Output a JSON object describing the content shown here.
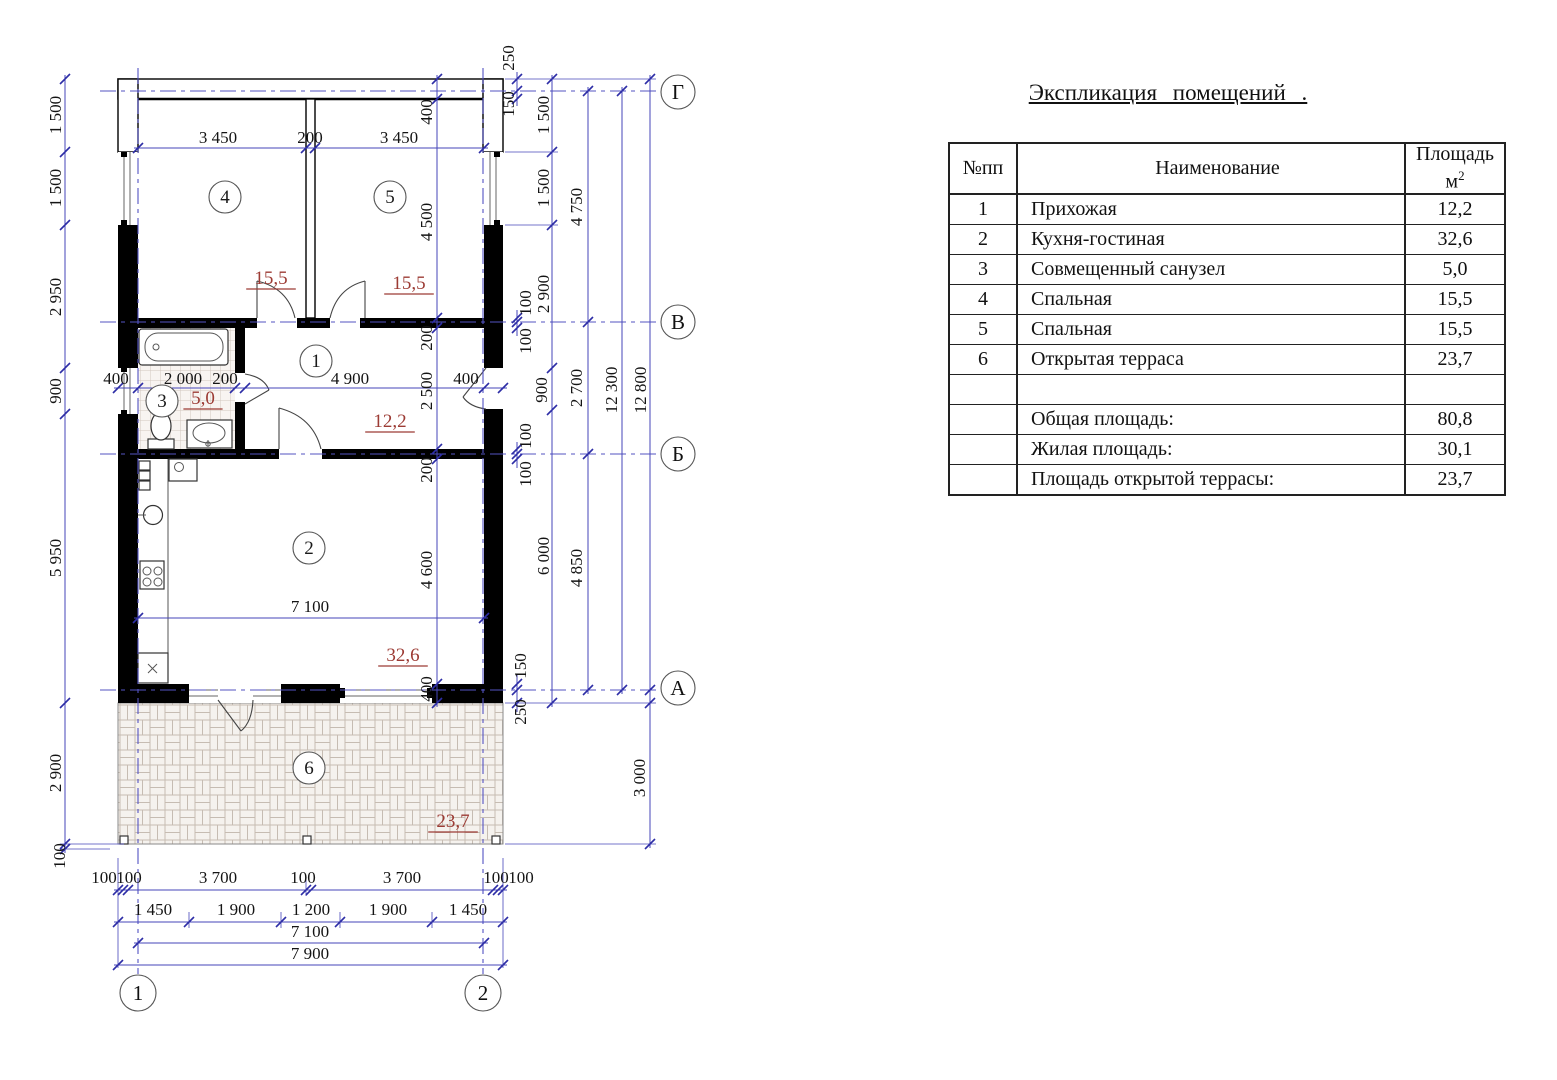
{
  "title": "Экспликация помещений .",
  "table": {
    "col_num": "№пп",
    "col_name": "Наименование",
    "col_area_line1": "Площадь",
    "col_area_unit": "м",
    "col_area_sup": "2",
    "rows": [
      {
        "num": "1",
        "name": "Прихожая",
        "area": "12,2"
      },
      {
        "num": "2",
        "name": "Кухня-гостиная",
        "area": "32,6"
      },
      {
        "num": "3",
        "name": "Совмещенный санузел",
        "area": "5,0"
      },
      {
        "num": "4",
        "name": "Спальная",
        "area": "15,5"
      },
      {
        "num": "5",
        "name": "Спальная",
        "area": "15,5"
      },
      {
        "num": "6",
        "name": "Открытая терраса",
        "area": "23,7"
      },
      {
        "num": "",
        "name": "",
        "area": ""
      },
      {
        "num": "",
        "name": "Общая площадь:",
        "area": "80,8"
      },
      {
        "num": "",
        "name": "Жилая площадь:",
        "area": "30,1"
      },
      {
        "num": "",
        "name": "Площадь открытой террасы:",
        "area": "23,7"
      }
    ]
  },
  "plan": {
    "axis_letters": [
      {
        "t": "Г",
        "x": 678,
        "y": 92
      },
      {
        "t": "В",
        "x": 678,
        "y": 322
      },
      {
        "t": "Б",
        "x": 678,
        "y": 454
      },
      {
        "t": "А",
        "x": 678,
        "y": 688
      }
    ],
    "axis_numbers": [
      {
        "t": "1",
        "x": 138,
        "y": 993
      },
      {
        "t": "2",
        "x": 483,
        "y": 993
      }
    ],
    "rooms": [
      {
        "t": "4",
        "x": 225,
        "y": 197
      },
      {
        "t": "5",
        "x": 390,
        "y": 197
      },
      {
        "t": "1",
        "x": 316,
        "y": 361
      },
      {
        "t": "3",
        "x": 162,
        "y": 401
      },
      {
        "t": "2",
        "x": 309,
        "y": 548
      },
      {
        "t": "6",
        "x": 309,
        "y": 768
      }
    ],
    "areas": [
      {
        "t": "15,5",
        "x": 271,
        "y": 278
      },
      {
        "t": "15,5",
        "x": 409,
        "y": 283
      },
      {
        "t": "5,0",
        "x": 203,
        "y": 398
      },
      {
        "t": "12,2",
        "x": 390,
        "y": 421
      },
      {
        "t": "32,6",
        "x": 403,
        "y": 655
      },
      {
        "t": "23,7",
        "x": 453,
        "y": 821
      }
    ],
    "dims": [
      {
        "t": "1 500",
        "x": 56,
        "y": 115,
        "r": 1
      },
      {
        "t": "1 500",
        "x": 56,
        "y": 188,
        "r": 1
      },
      {
        "t": "2 950",
        "x": 56,
        "y": 297,
        "r": 1
      },
      {
        "t": "900",
        "x": 56,
        "y": 391,
        "r": 1
      },
      {
        "t": "5 950",
        "x": 56,
        "y": 558,
        "r": 1
      },
      {
        "t": "2 900",
        "x": 56,
        "y": 773,
        "r": 1
      },
      {
        "t": "100",
        "x": 60,
        "y": 856,
        "r": 1
      },
      {
        "t": "3 450",
        "x": 218,
        "y": 137
      },
      {
        "t": "200",
        "x": 310,
        "y": 137
      },
      {
        "t": "3 450",
        "x": 399,
        "y": 137
      },
      {
        "t": "400",
        "x": 427,
        "y": 112,
        "r": 1
      },
      {
        "t": "4 500",
        "x": 427,
        "y": 222,
        "r": 1
      },
      {
        "t": "200",
        "x": 427,
        "y": 338,
        "r": 1
      },
      {
        "t": "2 500",
        "x": 427,
        "y": 391,
        "r": 1
      },
      {
        "t": "200",
        "x": 427,
        "y": 470,
        "r": 1
      },
      {
        "t": "4 600",
        "x": 427,
        "y": 570,
        "r": 1
      },
      {
        "t": "400",
        "x": 427,
        "y": 689,
        "r": 1
      },
      {
        "t": "250",
        "x": 509,
        "y": 58,
        "r": 1
      },
      {
        "t": "150",
        "x": 509,
        "y": 104,
        "r": 1
      },
      {
        "t": "100",
        "x": 526,
        "y": 303,
        "r": 1
      },
      {
        "t": "100",
        "x": 526,
        "y": 341,
        "r": 1
      },
      {
        "t": "100",
        "x": 526,
        "y": 436,
        "r": 1
      },
      {
        "t": "100",
        "x": 526,
        "y": 474,
        "r": 1
      },
      {
        "t": "150",
        "x": 521,
        "y": 666,
        "r": 1
      },
      {
        "t": "250",
        "x": 521,
        "y": 712,
        "r": 1
      },
      {
        "t": "400",
        "x": 116,
        "y": 378
      },
      {
        "t": "2 000",
        "x": 183,
        "y": 378
      },
      {
        "t": "200",
        "x": 225,
        "y": 378
      },
      {
        "t": "4 900",
        "x": 350,
        "y": 378
      },
      {
        "t": "400",
        "x": 466,
        "y": 378
      },
      {
        "t": "7 100",
        "x": 310,
        "y": 606
      },
      {
        "t": "1 500",
        "x": 544,
        "y": 115,
        "r": 1
      },
      {
        "t": "1 500",
        "x": 544,
        "y": 188,
        "r": 1
      },
      {
        "t": "2 900",
        "x": 544,
        "y": 294,
        "r": 1
      },
      {
        "t": "900",
        "x": 542,
        "y": 390,
        "r": 1
      },
      {
        "t": "6 000",
        "x": 544,
        "y": 556,
        "r": 1
      },
      {
        "t": "4 750",
        "x": 577,
        "y": 207,
        "r": 1
      },
      {
        "t": "2 700",
        "x": 577,
        "y": 388,
        "r": 1
      },
      {
        "t": "4 850",
        "x": 577,
        "y": 568,
        "r": 1
      },
      {
        "t": "12 300",
        "x": 612,
        "y": 390,
        "r": 1
      },
      {
        "t": "12 800",
        "x": 641,
        "y": 390,
        "r": 1
      },
      {
        "t": "3 000",
        "x": 640,
        "y": 778,
        "r": 1
      },
      {
        "t": "100",
        "x": 104,
        "y": 877
      },
      {
        "t": "100",
        "x": 129,
        "y": 877
      },
      {
        "t": "3 700",
        "x": 218,
        "y": 877
      },
      {
        "t": "100",
        "x": 303,
        "y": 877
      },
      {
        "t": "3 700",
        "x": 402,
        "y": 877
      },
      {
        "t": "100",
        "x": 496,
        "y": 877
      },
      {
        "t": "100",
        "x": 521,
        "y": 877
      },
      {
        "t": "1 450",
        "x": 153,
        "y": 909
      },
      {
        "t": "1 900",
        "x": 236,
        "y": 909
      },
      {
        "t": "1 200",
        "x": 311,
        "y": 909
      },
      {
        "t": "1 900",
        "x": 388,
        "y": 909
      },
      {
        "t": "1 450",
        "x": 468,
        "y": 909
      },
      {
        "t": "7 100",
        "x": 310,
        "y": 931
      },
      {
        "t": "7 900",
        "x": 310,
        "y": 953
      }
    ]
  },
  "colors": {
    "dim_blue": "#4646ba",
    "area_red": "#9c3b34",
    "wall": "#000000"
  }
}
